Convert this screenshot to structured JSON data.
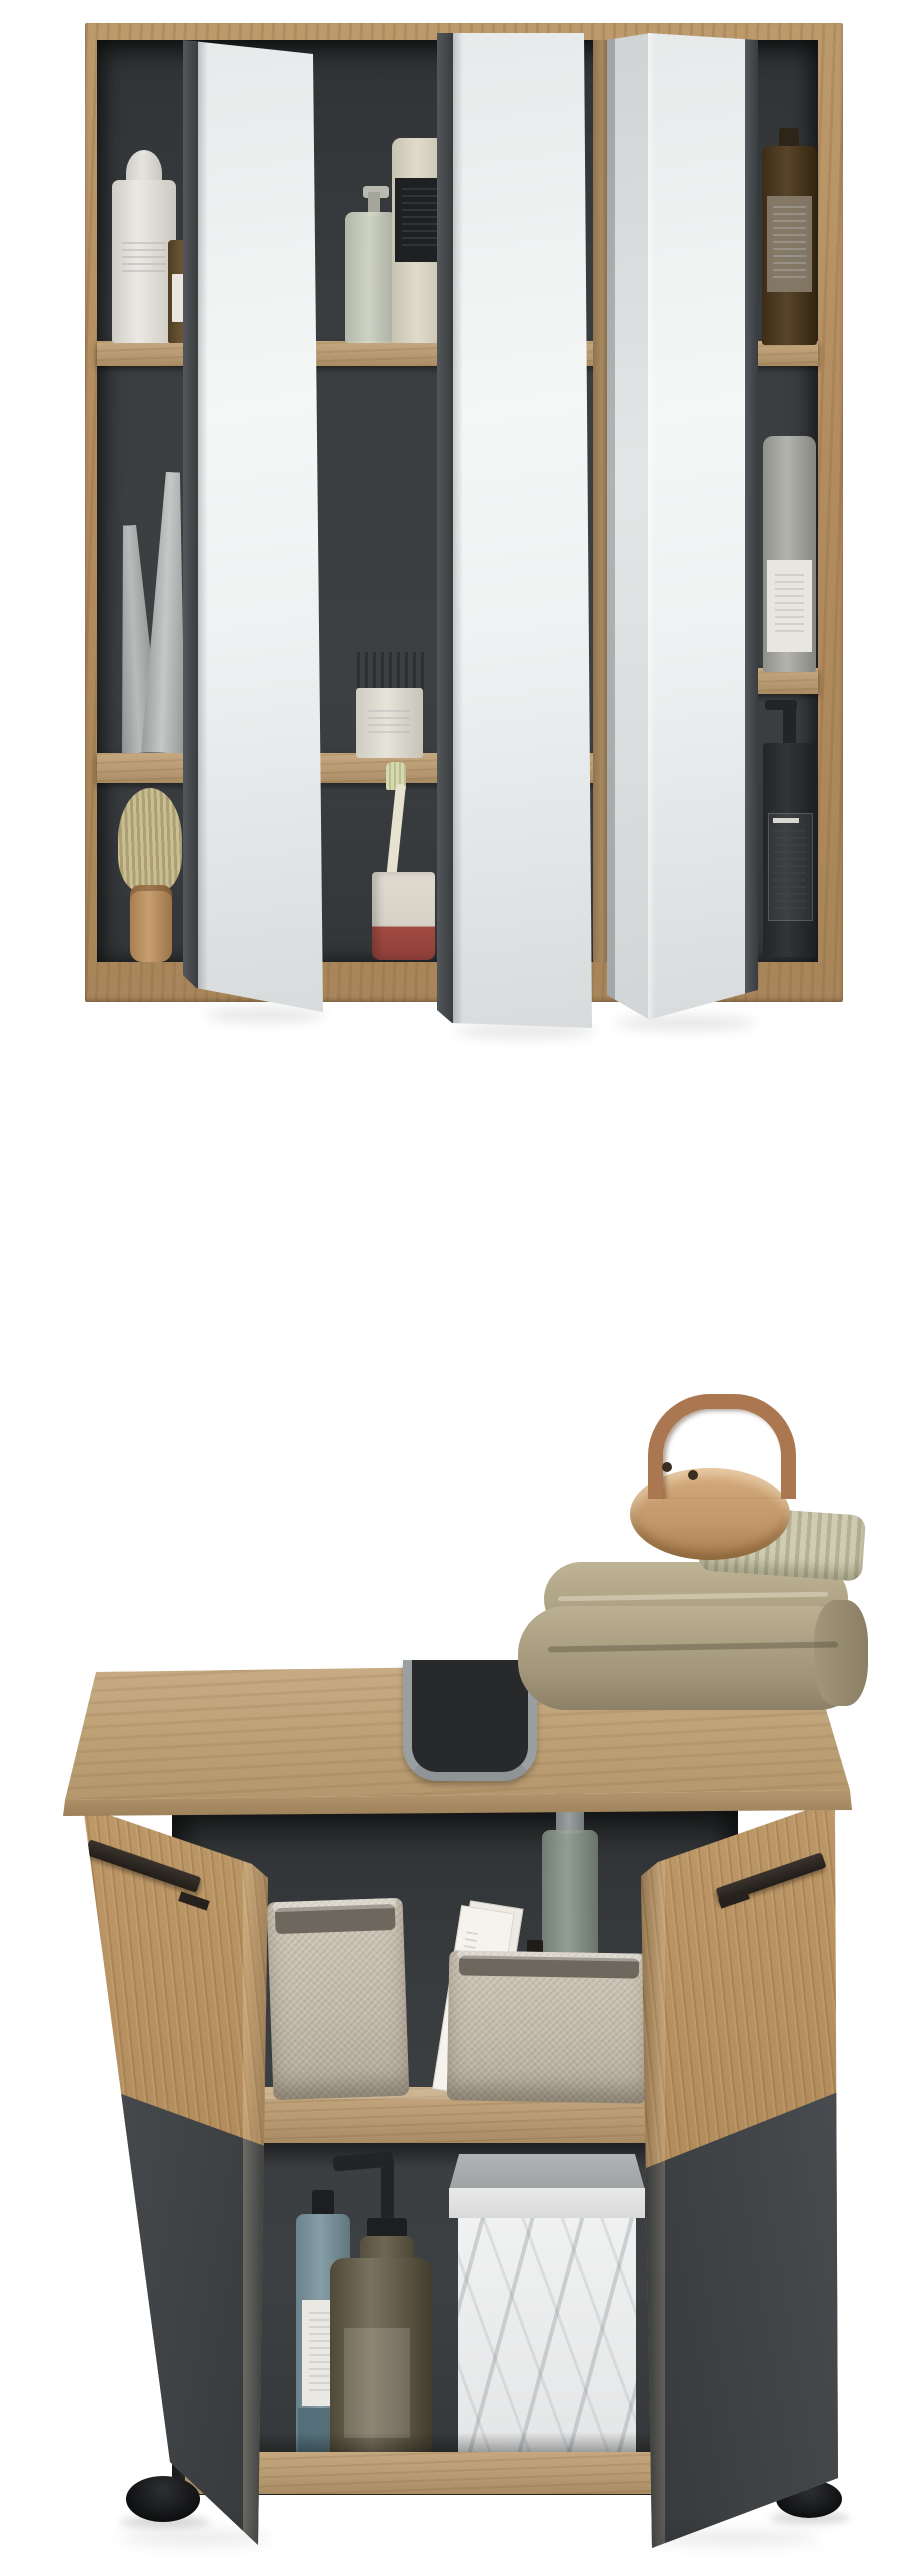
{
  "scene": {
    "kind": "furniture product photo, two-piece bathroom set",
    "background": "#ffffff"
  },
  "mirror_cabinet": {
    "label": "Wall mirror cabinet, oak with anthracite interior, three open mirror doors",
    "doors": [
      "left mirror door",
      "center mirror door",
      "right bi-fold mirror door"
    ],
    "shelf_items": [
      "white pump bottle with dome cap",
      "small amber bottle",
      "glass pump bottle",
      "cream bottle with black label",
      "dark amber apothecary bottle",
      "two grey cosmetic tubes",
      "dark jar with white base",
      "grey bottle with white label",
      "shaving brush",
      "toothbrush in white and red cup",
      "black pump bottle with printed label"
    ]
  },
  "vanity_cabinet": {
    "label": "Under-sink vanity cabinet, oak and anthracite, two open doors with black bar handles",
    "top_items": [
      "folded beige towel",
      "wooden massage brush with leather strap"
    ],
    "middle_shelf_items": [
      "grey fabric storage basket",
      "grey fabric storage basket with white cards",
      "glass spray bottle",
      "small amber dropper bottle"
    ],
    "bottom_items": [
      "blue-grey glass bottle with white label",
      "amber glass soap dispenser with black pump",
      "white marble storage box with grey lid"
    ],
    "hardware": [
      "siphon cutout with metal rim",
      "black bar handle left door",
      "black bar handle right door",
      "round black feet"
    ]
  },
  "palette": {
    "wood_frame": "#b28c5e",
    "wood_light": "#bfa37f",
    "wood_shelf": "#ab8d68",
    "anthracite": "#3a3d40",
    "anthracite_panel": "#45484b",
    "mirror_high": "#f5f7f7",
    "mirror_low": "#d7dadb",
    "handle_black": "#2a2522",
    "towel_beige": "#afa286",
    "brush_wood": "#c59c6e",
    "bristle": "#c9c6aa",
    "strap_leather": "#aa7750",
    "basket_fabric": "#c7beaf",
    "marble_white": "#ededee",
    "marble_lid": "#a7abab",
    "amber_glass": "#6e6552",
    "blue_glass": "#7e98a0",
    "metal_rim": "#9aa0a2",
    "foot_black": "#17181a"
  }
}
